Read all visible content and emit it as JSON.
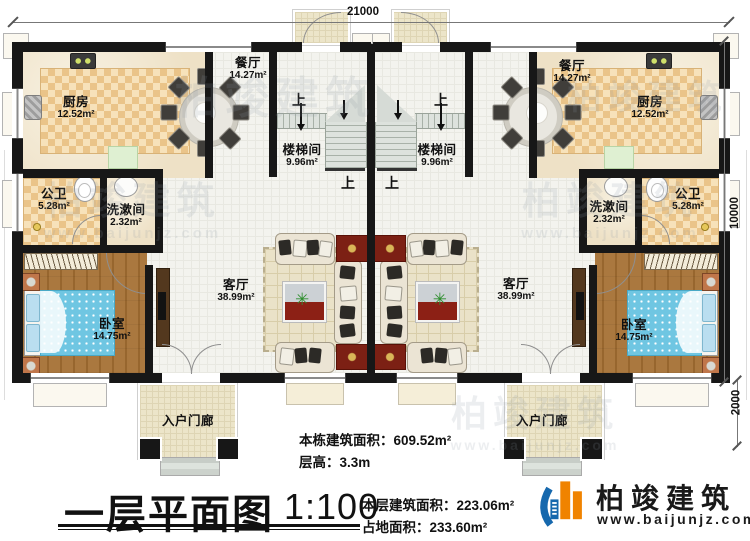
{
  "floorplan": {
    "title": "一层平面图",
    "scale": "1:100",
    "stats": [
      {
        "label": "本栋建筑面积：",
        "value": "609.52m²"
      },
      {
        "label": "层高：",
        "value": "3.3m"
      },
      {
        "label": "本层建筑面积：",
        "value": "223.06m²"
      },
      {
        "label": "占地面积：",
        "value": "233.60m²"
      }
    ],
    "dimensions": {
      "top": "21000",
      "side": "10000",
      "porch": "2000"
    },
    "stair_up": "上",
    "rooms": {
      "left": {
        "kitchen": {
          "name": "厨房",
          "area": "12.52m²"
        },
        "dining": {
          "name": "餐厅",
          "area": "14.27m²"
        },
        "stairwell": {
          "name": "楼梯间",
          "area": "9.96m²"
        },
        "bathroom": {
          "name": "公卫",
          "area": "5.28m²"
        },
        "washroom": {
          "name": "洗漱间",
          "area": "2.32m²"
        },
        "bedroom": {
          "name": "卧室",
          "area": "14.75m²"
        },
        "living": {
          "name": "客厅",
          "area": "38.99m²"
        },
        "porch": {
          "name": "入户门廊"
        }
      },
      "right": {
        "kitchen": {
          "name": "厨房",
          "area": "12.52m²"
        },
        "dining": {
          "name": "餐厅",
          "area": "14.27m²"
        },
        "stairwell": {
          "name": "楼梯间",
          "area": "9.96m²"
        },
        "bathroom": {
          "name": "公卫",
          "area": "5.28m²"
        },
        "washroom": {
          "name": "洗漱间",
          "area": "2.32m²"
        },
        "bedroom": {
          "name": "卧室",
          "area": "14.75m²"
        },
        "living": {
          "name": "客厅",
          "area": "38.99m²"
        },
        "porch": {
          "name": "入户门廊"
        }
      }
    },
    "colors": {
      "wall": "#171717",
      "tile": "#eac489",
      "wood": "#aa783f",
      "accent_red": "#7c2014",
      "brand_blue": "#1668ad",
      "brand_orange": "#f08300"
    }
  },
  "branding": {
    "name": "柏竣建筑",
    "website": "www.baijunjz.com"
  },
  "watermark": {
    "text": "柏竣建筑",
    "website": "www.baijunjz.com"
  }
}
